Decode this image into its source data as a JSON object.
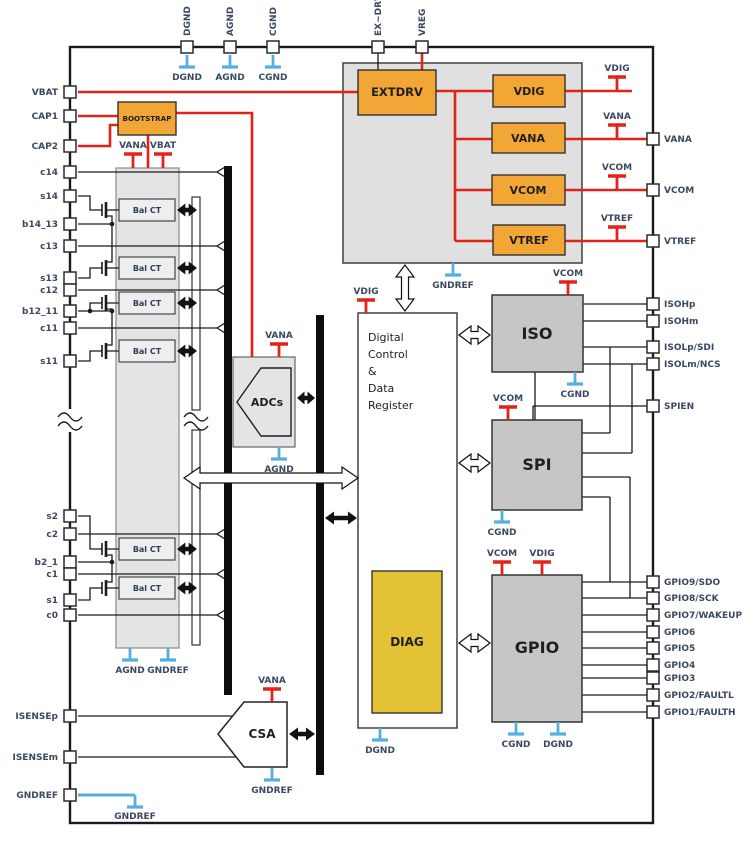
{
  "diagram": {
    "description": "Battery monitor IC functional block diagram"
  },
  "colors": {
    "red": "#e2231a",
    "blue": "#54aee0",
    "orange": "#f2a636",
    "gold": "#e3c235",
    "block_gray": "#c6c6c6",
    "container_gray": "#e4e4e4",
    "label_navy": "#3a4961",
    "wire_black": "#1a1a1a"
  },
  "blocks": {
    "extdrv": "EXTDRV",
    "vdig": "VDIG",
    "vana": "VANA",
    "vcom": "VCOM",
    "vtref": "VTREF",
    "bootstrap": "BOOTSTRAP",
    "bal_ct": "Bal CT",
    "adcs": "ADCs",
    "csa": "CSA",
    "iso": "ISO",
    "spi": "SPI",
    "gpio": "GPIO",
    "diag": "DIAG",
    "digital_control_lines": [
      "Digital",
      "Control",
      "&",
      "Data",
      "Register"
    ]
  },
  "pins": {
    "top": [
      "DGND",
      "AGND",
      "CGND",
      "EX~DRV",
      "VREG"
    ],
    "left": [
      "VBAT",
      "CAP1",
      "CAP2",
      "c14",
      "s14",
      "b14_13",
      "c13",
      "s13",
      "c12",
      "b12_11",
      "c11",
      "s11",
      "s2",
      "c2",
      "b2_1",
      "c1",
      "s1",
      "c0",
      "ISENSEp",
      "ISENSEm",
      "GNDREF"
    ],
    "right": [
      "VANA",
      "VCOM",
      "VTREF",
      "ISOHp",
      "ISOHm",
      "ISOLp/SDI",
      "ISOLm/NCS",
      "SPIEN",
      "GPIO9/SDO",
      "GPIO8/SCK",
      "GPIO7/WAKEUP",
      "GPIO6",
      "GPIO5",
      "GPIO4",
      "GPIO3",
      "GPIO2/FAULTL",
      "GPIO1/FAULTH"
    ]
  },
  "supply_taps": [
    "VANA",
    "VBAT",
    "VANA",
    "VDIG",
    "VANA",
    "VCOM",
    "VTREF",
    "VDIG",
    "VCOM",
    "VCOM",
    "VCOM",
    "VDIG",
    "VANA"
  ],
  "ground_taps": [
    "DGND",
    "AGND",
    "CGND",
    "GNDREF",
    "AGND",
    "AGND",
    "GNDREF",
    "CGND",
    "CGND",
    "CGND",
    "DGND",
    "DGND",
    "GNDREF",
    "GNDREF"
  ]
}
